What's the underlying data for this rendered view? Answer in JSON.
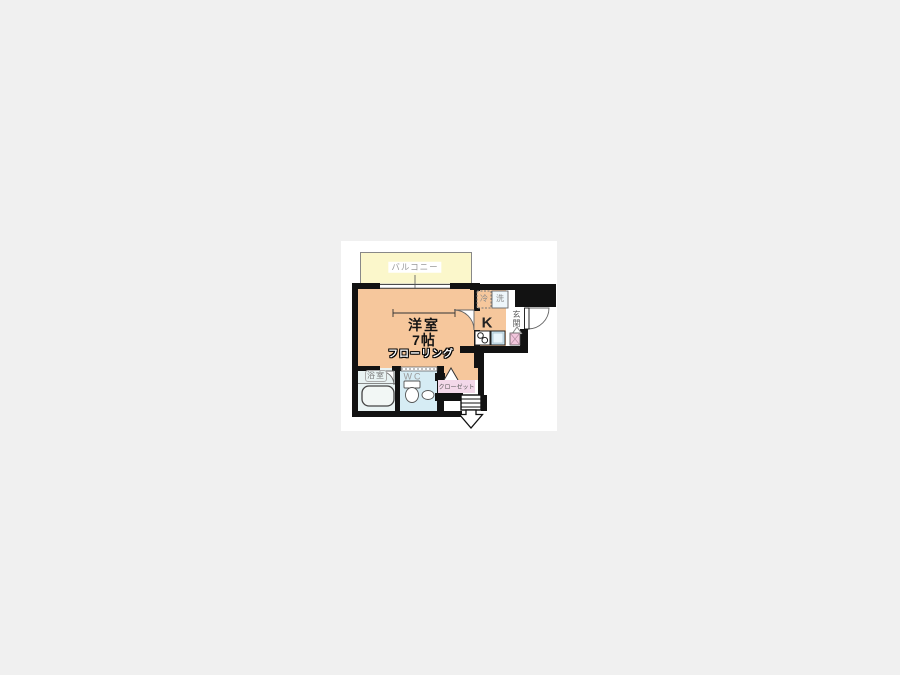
{
  "floor_plan": {
    "balcony": {
      "label": "バルコニー"
    },
    "main_room": {
      "name": "洋室",
      "size": "7帖",
      "floor_type": "フローリング"
    },
    "kitchen": {
      "label": "K",
      "fridge": "冷",
      "washer": "洗"
    },
    "entrance": {
      "label": "玄関"
    },
    "bathroom": {
      "label": "浴室"
    },
    "toilet": {
      "label": "WC"
    },
    "closet": {
      "label": "クローゼット"
    },
    "colors": {
      "page_bg": "#f0f0f0",
      "canvas": "#ffffff",
      "wall": "#121212",
      "room": "#f6c79c",
      "balcony": "#fbf7cb",
      "bath": "#e9f3f3",
      "wc": "#d6ecf4",
      "closet_bg": "#f3d8e9",
      "shoe": "#f3c6dd",
      "sink": "#cfe7f2",
      "washer_bg": "#eef6fa"
    }
  }
}
